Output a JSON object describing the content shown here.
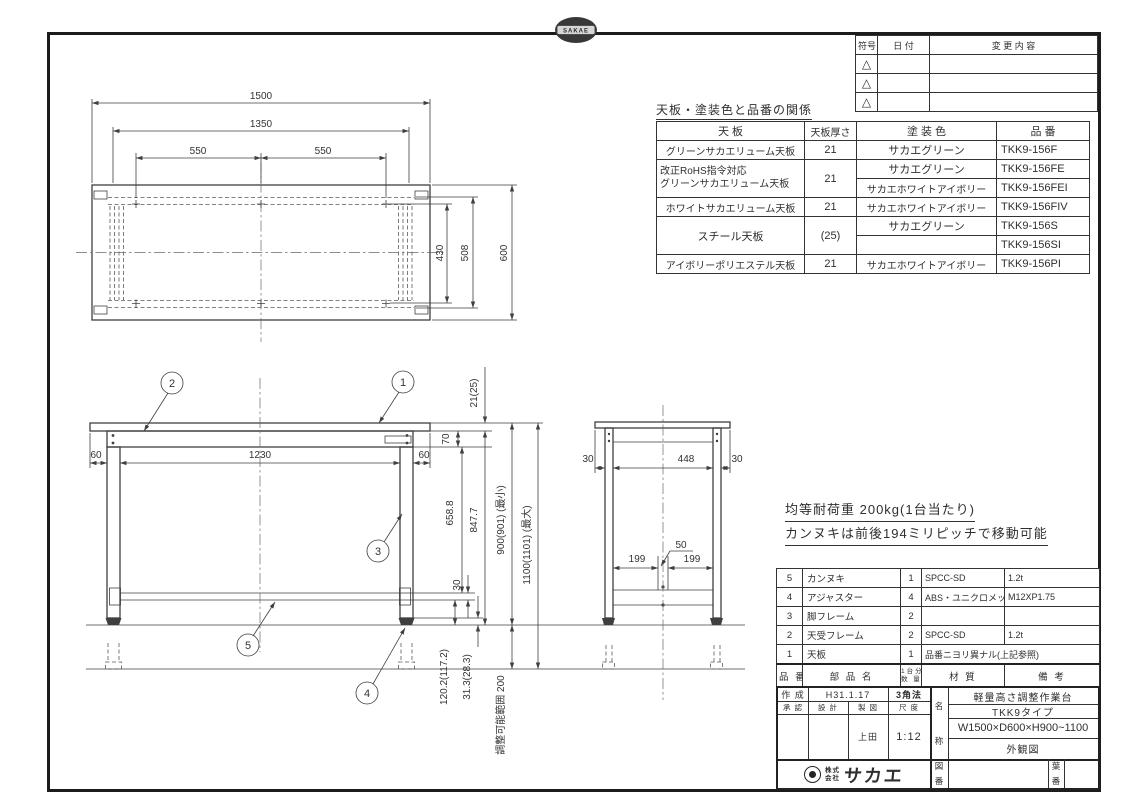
{
  "colors": {
    "paper": "#ffffff",
    "line": "#3f3f3f",
    "frame_border": "#1c1c1c",
    "text": "#2f2f2f"
  },
  "stamp": {
    "brand": "SAKAE"
  },
  "revision_table": {
    "col_symbol": "符号",
    "col_date": "日 付",
    "col_change": "変 更 内 容",
    "rows": [
      {
        "symbol": "△"
      },
      {
        "symbol": "△"
      },
      {
        "symbol": "△"
      }
    ]
  },
  "finish_table": {
    "title": "天板・塗装色と品番の関係",
    "h_top": "天  板",
    "h_thickness": "天板厚さ",
    "h_color": "塗 装 色",
    "h_part": "品  番",
    "r1": {
      "top": "グリーンサカエリューム天板",
      "t": "21",
      "color": "サカエグリーン",
      "no": "TKK9-156F"
    },
    "r2": {
      "top1": "改正RoHS指令対応",
      "top2": "グリーンサカエリューム天板",
      "t": "21",
      "color_a": "サカエグリーン",
      "no_a": "TKK9-156FE",
      "color_b": "サカエホワイトアイボリー",
      "no_b": "TKK9-156FEI"
    },
    "r3": {
      "top": "ホワイトサカエリューム天板",
      "t": "21",
      "color": "サカエホワイトアイボリー",
      "no": "TKK9-156FIV"
    },
    "r4": {
      "top": "スチール天板",
      "t": "(25)",
      "color_a": "サカエグリーン",
      "no_a": "TKK9-156S",
      "color_b": "サカエホワイトアイボリー",
      "no_b": "TKK9-156SI"
    },
    "r5": {
      "top": "アイボリーポリエステル天板",
      "t": "21",
      "color": "サカエホワイトアイボリー",
      "no": "TKK9-156PI"
    }
  },
  "notes": {
    "line1": "均等耐荷重 200kg(1台当たり)",
    "line2": "カンヌキは前後194ミリピッチで移動可能"
  },
  "plan": {
    "d1500": "1500",
    "d1350": "1350",
    "d550l": "550",
    "d550r": "550",
    "d430": "430",
    "d508": "508",
    "d600": "600"
  },
  "front": {
    "d60l": "60",
    "d1230": "1230",
    "d60r": "60",
    "d21": "21(25)",
    "d70": "70",
    "d658": "658.8",
    "d847": "847.7",
    "d900": "900(901) (最小)",
    "d1100": "1100(1101) (最大)",
    "d30": "30",
    "d120": "120.2(117.2)",
    "d31": "31.3(28.3)",
    "drange": "調整可能範囲  200"
  },
  "side": {
    "d30l": "30",
    "d448": "448",
    "d30r": "30",
    "d50": "50",
    "d199l": "199",
    "d199r": "199"
  },
  "balloons": {
    "b1": "1",
    "b2": "2",
    "b3": "3",
    "b4": "4",
    "b5": "5"
  },
  "parts_table": {
    "h_no": "品 番",
    "h_name": "部 品 名",
    "h_qty1": "1台分",
    "h_qty2": "数 量",
    "h_material": "材   質",
    "h_remarks": "備   考",
    "rows": [
      {
        "no": "5",
        "name": "カンヌキ",
        "qty": "1",
        "material": "SPCC-SD",
        "remarks": "1.2t"
      },
      {
        "no": "4",
        "name": "アジャスター",
        "qty": "4",
        "material": "ABS・ユニクロメッキ",
        "remarks": "M12XP1.75"
      },
      {
        "no": "3",
        "name": "脚フレーム",
        "qty": "2",
        "material": "",
        "remarks": ""
      },
      {
        "no": "2",
        "name": "天受フレーム",
        "qty": "2",
        "material": "SPCC-SD",
        "remarks": "1.2t"
      },
      {
        "no": "1",
        "name": "天板",
        "qty": "1",
        "material": "品番ニヨリ異ナル(上記参照)"
      }
    ]
  },
  "title_block": {
    "created_label": "作 成",
    "created_date": "H31.1.17",
    "projection": "3角法",
    "approved_label": "承 認",
    "design_label": "設 計",
    "draft_label": "製 図",
    "scale_label": "尺 度",
    "drafter": "上田",
    "scale": "1:12",
    "name_label_top": "名",
    "name_label_bottom": "称",
    "product_type": "軽量高さ調整作業台",
    "product_series": "TKK9タイプ",
    "product_size": "W1500×D600×H900~1100",
    "view_type": "外観図",
    "company_top": "株式",
    "company_bottom": "会社",
    "company_name": "サカエ",
    "dwgno_top": "図",
    "dwgno_bottom": "番",
    "sheet_top": "葉",
    "sheet_bottom": "番"
  }
}
